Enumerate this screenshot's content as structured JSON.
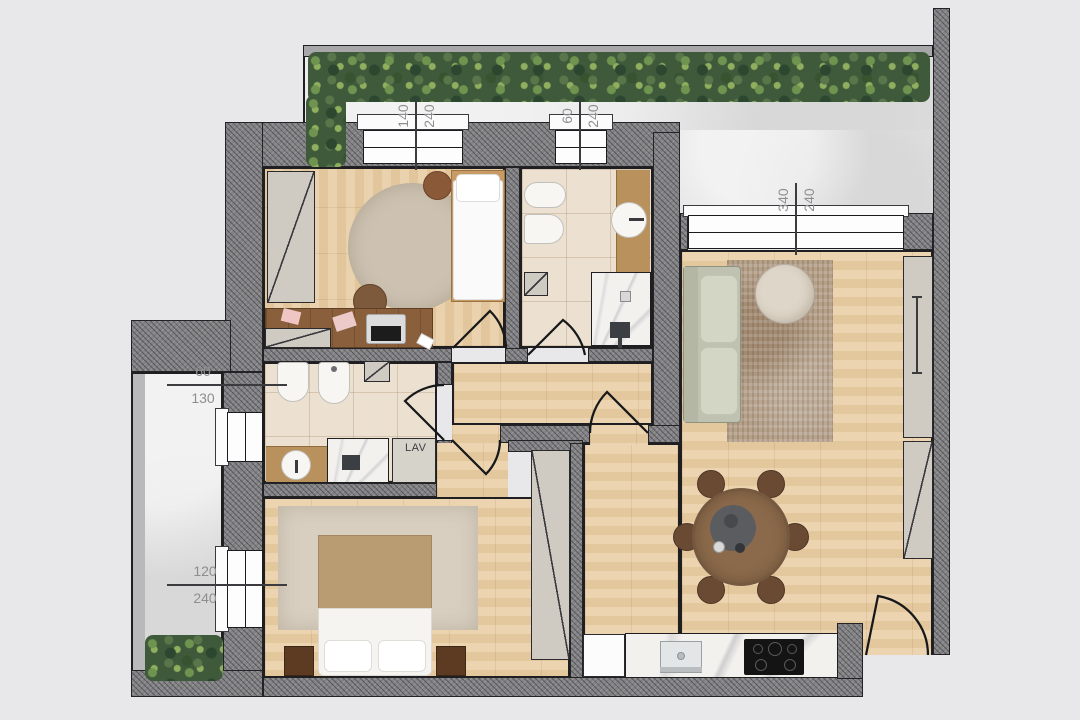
{
  "plan": {
    "dimensions": {
      "win_bedroom1": {
        "w": "140",
        "h": "240"
      },
      "win_bath1": {
        "w": "60",
        "h": "240"
      },
      "win_living": {
        "w": "340",
        "h": "240"
      },
      "win_bath2": {
        "w": "60",
        "h": "130"
      },
      "win_master": {
        "w": "120",
        "h": "240"
      }
    },
    "labels": {
      "laundry": "LAV"
    },
    "colors": {
      "background": "#e8e8ea",
      "wall_hatch": "#828285",
      "wood_floor": "#e9cfa6",
      "tile_floor": "#ece1d0",
      "terrace_floor": "#e2e2e3",
      "greenery": "#3f5a3b",
      "dimension_text": "#8e8e91",
      "sofa": "#c9ccba",
      "dining_table": "#8b6a4b"
    }
  }
}
